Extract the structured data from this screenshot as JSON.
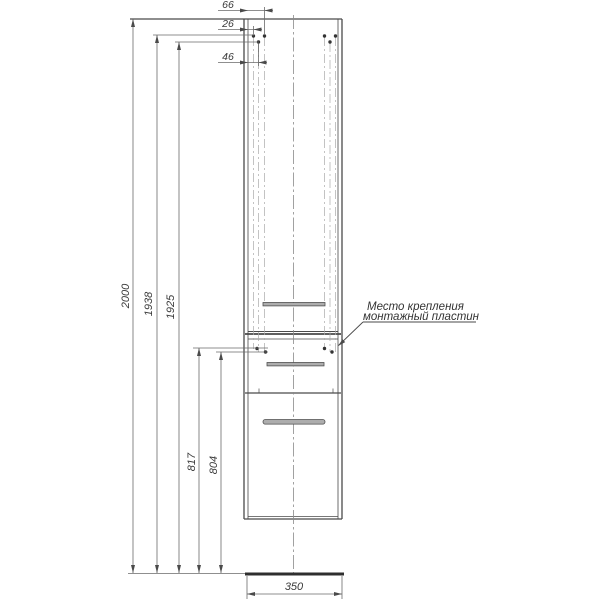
{
  "annotation": {
    "line1": "Место крепления",
    "line2": "монтажный пластин"
  },
  "dims": {
    "top": {
      "d66": "66",
      "d26": "26",
      "d46": "46"
    },
    "left": {
      "d2000": "2000",
      "d1938": "1938",
      "d1925": "1925",
      "d817": "817",
      "d804": "804"
    },
    "bottom": {
      "d350": "350"
    }
  },
  "colors": {
    "main_line": "#4a4a4a",
    "dim_line": "#6a6a6a",
    "guide_line": "#aaaaaa",
    "handle_fill": "#adadad",
    "handle_stroke": "#4f4f4f",
    "floor_line": "#2f2f2f",
    "text": "#3a3a3a",
    "background": "#ffffff"
  }
}
